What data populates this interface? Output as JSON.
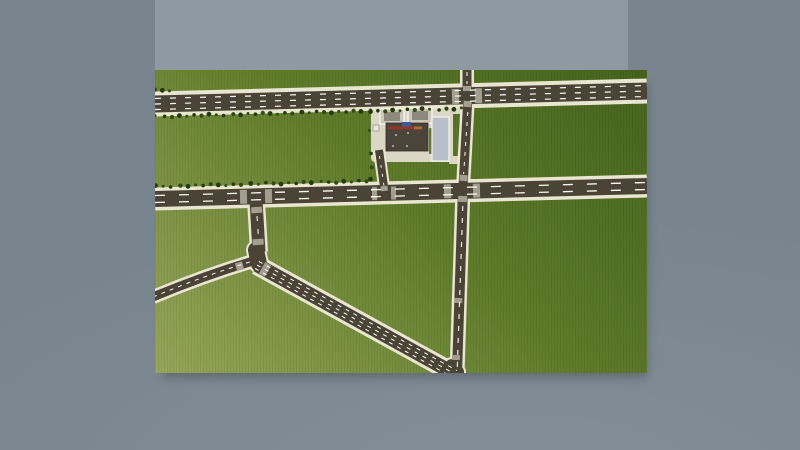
{
  "scene": {
    "description": "aerial-top-down-road-network-render",
    "background": {
      "outer_color": "#7d8992",
      "panel_color": "#8e99a2",
      "shadow_color": "rgba(52,63,75,0.4)"
    },
    "map": {
      "x": 155,
      "y": 70,
      "width": 492,
      "height": 303,
      "terrain": {
        "dark": "#42611a",
        "mid": "#5d7a28",
        "light": "#95a458",
        "patch": "#5e7b2a"
      },
      "road_colors": {
        "asphalt": "#4a4336",
        "edge": "#eae5d0",
        "marking": "#fdfdf8",
        "crosswalk": "#a39e8f",
        "pavement": "#dcd7c5"
      },
      "roads": [
        {
          "id": "highway",
          "d": "M 0 34 L 492 21",
          "casing": 25,
          "asphalt": 17,
          "lanes": [
            {
              "d": "M 0 28.5 L 492 15.5",
              "dash": "6 9",
              "w": 1.2
            },
            {
              "d": "M 0 34 L 492 21",
              "dash": "6 9",
              "w": 1.2
            },
            {
              "d": "M 0 39.5 L 492 26.5",
              "dash": "6 9",
              "w": 1.2
            }
          ]
        },
        {
          "id": "north-stub",
          "d": "M 312 -1 L 312 26",
          "casing": 14,
          "asphalt": 9,
          "lanes": [
            {
              "d": "M 312 2 L 312 14",
              "dash": "4 5",
              "w": 1
            }
          ]
        },
        {
          "id": "station-vertical",
          "d": "M 313 26 L 308 118",
          "casing": 14,
          "asphalt": 9,
          "lanes": [
            {
              "d": "M 312.8 42 L 308.6 104",
              "dash": "4 6",
              "w": 1
            }
          ]
        },
        {
          "id": "main-vertical",
          "d": "M 308 118 L 302 303",
          "casing": 15,
          "asphalt": 10,
          "lanes": [
            {
              "d": "M 307.8 136 L 302.2 300",
              "dash": "5 7",
              "w": 1.1
            }
          ]
        },
        {
          "id": "middle-road",
          "d": "M 0 129 L 492 116",
          "casing": 23,
          "asphalt": 16,
          "lanes": [
            {
              "d": "M 0 125.5 L 492 112.5",
              "dash": "10 14",
              "w": 1.3
            },
            {
              "d": "M 0 132.5 L 492 119.5",
              "dash": "10 14",
              "w": 1.3
            }
          ]
        },
        {
          "id": "t-stub",
          "d": "M 101 130 L 104 182",
          "casing": 18,
          "asphalt": 13,
          "lanes": [
            {
              "d": "M 102 146 L 103.4 166",
              "dash": "5 8",
              "w": 1
            }
          ]
        },
        {
          "id": "junction-blob",
          "d": "M 101 180 L 104 194",
          "casing": 20,
          "asphalt": 16,
          "cap": "round",
          "lanes": []
        },
        {
          "id": "curve-road",
          "d": "M -2 227 Q 48 206 98 191",
          "casing": 14,
          "asphalt": 9,
          "lanes": [
            {
              "d": "M -2 227 Q 48 206 98 191",
              "dash": "4 5",
              "w": 1
            }
          ]
        },
        {
          "id": "diagonal-road",
          "d": "M 102 195 L 300 304",
          "casing": 20,
          "asphalt": 14,
          "lanes": [
            {
              "d": "M 103.9 191.5 L 301.9 300.5",
              "dash": "4 5",
              "w": 1
            },
            {
              "d": "M 102 195 L 300 304",
              "dash": "4 5",
              "w": 1
            },
            {
              "d": "M 100.1 198.5 L 298.1 307.5",
              "dash": "4 5",
              "w": 1
            }
          ]
        },
        {
          "id": "merge-blob",
          "d": "M 297 296 L 302 302",
          "casing": 18,
          "asphalt": 14,
          "cap": "round",
          "lanes": []
        },
        {
          "id": "service-road",
          "d": "M 224 80 L 230 124",
          "casing": 12,
          "asphalt": 8,
          "lanes": [
            {
              "d": "M 224.5 86 L 229.3 118",
              "dash": "3 6",
              "w": 0.9
            }
          ]
        }
      ],
      "crosswalks": [
        {
          "id": "hw-west-approach",
          "d": "M 297 26.6 L 304 26.4",
          "w": 15
        },
        {
          "id": "hw-east-approach",
          "d": "M 320 25.9 L 327 25.7",
          "w": 15
        },
        {
          "id": "hw-north-approach",
          "d": "M 312 16 L 312 21",
          "w": 8
        },
        {
          "id": "hw-south-approach",
          "d": "M 312.7 31 L 312.4 37",
          "w": 8
        },
        {
          "id": "crossroads-west",
          "d": "M 289 121.4 L 296 121.2",
          "w": 14
        },
        {
          "id": "crossroads-east",
          "d": "M 318 120.7 L 325 120.5",
          "w": 14
        },
        {
          "id": "crossroads-north",
          "d": "M 308.7 105 L 308.4 111",
          "w": 8
        },
        {
          "id": "crossroads-south",
          "d": "M 307.7 126 L 307.5 132",
          "w": 9
        },
        {
          "id": "t-west",
          "d": "M 85 126.9 L 92 126.7",
          "w": 14
        },
        {
          "id": "t-east",
          "d": "M 110 126.2 L 117 126.0",
          "w": 14
        },
        {
          "id": "t-stub-north",
          "d": "M 101.5 137 L 101.9 143",
          "w": 11
        },
        {
          "id": "t-stub-south",
          "d": "M 102.9 169 L 103.3 175",
          "w": 11
        },
        {
          "id": "curve-approach",
          "d": "M 81 197.2 L 88 195.2",
          "w": 8
        },
        {
          "id": "diagonal-approach",
          "d": "M 107 197.8 L 113 201.1",
          "w": 13
        },
        {
          "id": "service-south",
          "d": "M 229 116 L 229.4 121",
          "w": 7
        },
        {
          "id": "service-west",
          "d": "M 217 123.6 L 222 123.5",
          "w": 13
        },
        {
          "id": "service-east",
          "d": "M 236 123.1 L 241 123.0",
          "w": 13
        },
        {
          "id": "vlower-mid",
          "d": "M 303.4 228 L 303.2 233",
          "w": 8
        },
        {
          "id": "vlower-merge",
          "d": "M 301 285 L 300.8 290",
          "w": 8
        }
      ],
      "gas_station": {
        "pavement": [
          {
            "name": "station-pavement",
            "x": 216,
            "y": 35,
            "w": 82,
            "h": 57,
            "rx": 4,
            "fill": "pavement"
          },
          {
            "name": "station-driveway-north",
            "x": 294,
            "y": 36,
            "w": 14,
            "h": 8,
            "rx": 1,
            "fill": "pavement"
          },
          {
            "name": "station-driveway-south",
            "x": 294,
            "y": 86,
            "w": 14,
            "h": 8,
            "rx": 1,
            "fill": "pavement"
          },
          {
            "name": "grass-strip",
            "x": 274,
            "y": 58,
            "w": 8,
            "h": 26,
            "rx": 1,
            "fill": "patch"
          }
        ],
        "buildings": [
          {
            "name": "fuel-canopy-west",
            "x": 225,
            "y": 39,
            "w": 24,
            "h": 15,
            "fill": "#cbc7bb",
            "stroke": "#f4f1e6",
            "sw": 1.5
          },
          {
            "name": "fuel-canopy-west-roof",
            "x": 229,
            "y": 42,
            "w": 16,
            "h": 9,
            "fill": "#8e897c"
          },
          {
            "name": "fuel-canopy-east",
            "x": 253,
            "y": 38,
            "w": 24,
            "h": 15,
            "fill": "#cbc7bb",
            "stroke": "#f4f1e6",
            "sw": 1.5
          },
          {
            "name": "fuel-canopy-east-roof",
            "x": 257,
            "y": 41,
            "w": 16,
            "h": 9,
            "fill": "#8e897c"
          },
          {
            "name": "station-building-roof",
            "x": 231,
            "y": 53,
            "w": 42,
            "h": 28,
            "fill": "#4b443a",
            "stroke": "#2e2a24",
            "sw": 0.8
          },
          {
            "name": "station-building-red-stripe",
            "x": 233,
            "y": 56.5,
            "w": 34,
            "h": 2.8,
            "fill": "#9a3424"
          },
          {
            "name": "station-building-orange-mark",
            "x": 259,
            "y": 56.5,
            "w": 8,
            "h": 2.8,
            "fill": "#b06c28"
          },
          {
            "name": "station-building-blue-sign",
            "x": 247,
            "y": 52,
            "w": 9,
            "h": 4.5,
            "fill": "#3c5b97"
          },
          {
            "name": "station-kiosk",
            "x": 218,
            "y": 55,
            "w": 6,
            "h": 6,
            "fill": "#e9e9e3",
            "stroke": "#8a8a84",
            "sw": 0.7
          },
          {
            "name": "parking-lot",
            "x": 277,
            "y": 47,
            "w": 17,
            "h": 44,
            "fill": "#b9bfc9",
            "stroke": "#f5f5f2",
            "sw": 1.2
          }
        ],
        "roof_dots": [
          [
            241,
            65
          ],
          [
            253,
            63
          ],
          [
            252,
            76
          ],
          [
            238,
            76
          ]
        ],
        "roof_dot_color": "#d9d9d4"
      },
      "trees": {
        "color_a": "#223c0e",
        "color_b": "#2f4d12",
        "rows": [
          {
            "x1": 1,
            "y1": 46.5,
            "x2": 306,
            "y2": 38.5,
            "count": 41
          },
          {
            "x1": 1,
            "y1": 116.5,
            "x2": 212,
            "y2": 111,
            "count": 28
          },
          {
            "x1": 0,
            "y1": 20.5,
            "x2": 15,
            "y2": 20,
            "count": 3
          }
        ],
        "singles": [
          [
            215,
            42
          ],
          [
            214,
            60
          ],
          [
            216,
            84
          ],
          [
            217,
            97
          ],
          [
            216,
            110
          ]
        ]
      }
    }
  }
}
